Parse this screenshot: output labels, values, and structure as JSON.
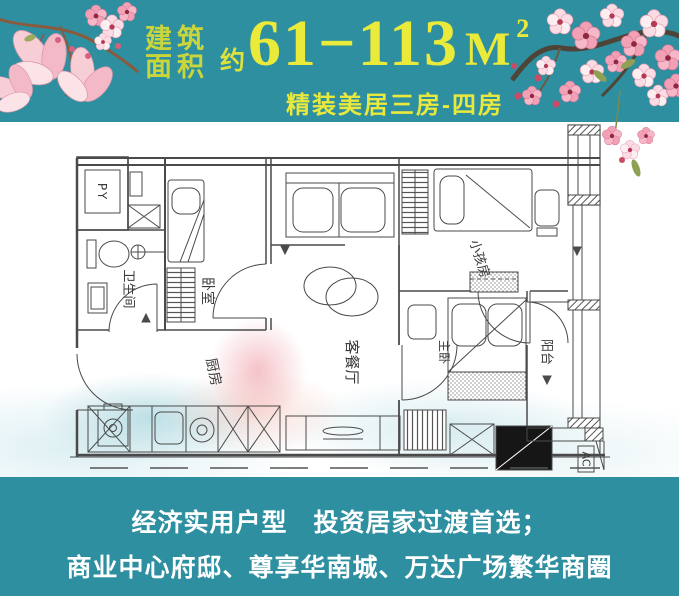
{
  "header": {
    "area_label_line1": "建筑",
    "area_label_line2": "面积",
    "approx_prefix": "约",
    "area_range": "61−113",
    "area_unit": "M",
    "area_unit_exponent": "2",
    "subtitle": "精装美居三房-四房"
  },
  "floorplan": {
    "rooms": {
      "shaft": "PY",
      "bathroom": "卫生间",
      "bedroom": "卧室",
      "kitchen": "厨房",
      "living_dining": "客餐厅",
      "kids_room": "小孩房",
      "master_bedroom": "主卧",
      "balcony": "阳台",
      "ac_platform": "AC"
    }
  },
  "footer": {
    "line1": "经济实用户型　投资居家过渡首选；",
    "line2": "商业中心府邸、尊享华南城、万达广场繁华商圈"
  },
  "colors": {
    "background_teal": "#2e8fa0",
    "headline_yellow": "#eaea3b",
    "label_yellow_green": "#c8d63c",
    "footer_white": "#ffffff",
    "plan_line_gray": "#4a4a4a",
    "blossom_pink": "#f2a0b6"
  }
}
